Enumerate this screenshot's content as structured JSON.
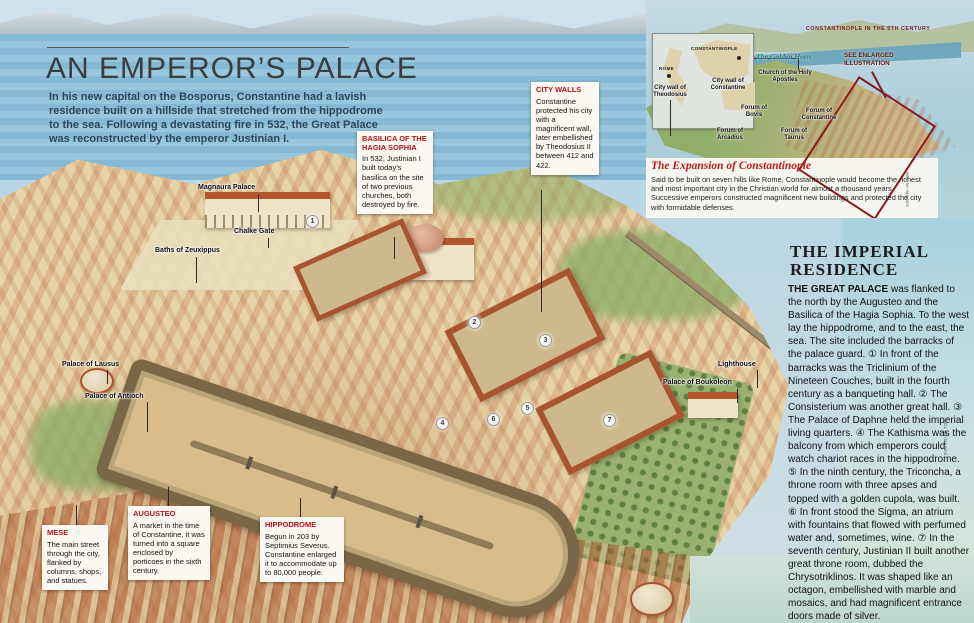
{
  "header": {
    "title": "AN EMPEROR’S PALACE",
    "intro": "In his new capital on the Bosporus, Constantine had a lavish residence built on a hillside that stretched from the hippodrome to the sea. Following a devastating fire in 532, the Great Palace was reconstructed by the emperor Justinian I."
  },
  "callouts": [
    {
      "title": "BASILICA OF THE HAGIA SOPHIA",
      "body": "In 532, Justinian I built today’s basilica on the site of two previous churches, both destroyed by fire."
    },
    {
      "title": "CITY WALLS",
      "body": "Constantine protected his city with a magnificent wall, later embellished by Theodosius II between 412 and 422."
    },
    {
      "title": "MESE",
      "body": "The main street through the city, flanked by columns, shops, and statues."
    },
    {
      "title": "AUGUSTEO",
      "body": "A market in the time of Constantine, it was turned into a square enclosed by porticoes in the sixth century."
    },
    {
      "title": "HIPPODROME",
      "body": "Begun in 203 by Septimius Severus. Constantine enlarged it to accommodate up to 80,000 people."
    }
  ],
  "map_labels": [
    {
      "text": "Magnaura Palace"
    },
    {
      "text": "Chalke Gate"
    },
    {
      "text": "Baths of Zeuxippus"
    },
    {
      "text": "Palace of Lausus"
    },
    {
      "text": "Palace of Antioch"
    },
    {
      "text": "Lighthouse"
    },
    {
      "text": "Palace of Boukoleon"
    }
  ],
  "markers": [
    "1",
    "2",
    "3",
    "4",
    "5",
    "6",
    "7"
  ],
  "inset": {
    "caption": "CONSTANTINOPLE IN THE 5TH CENTURY",
    "locator": {
      "city": "CONSTANTINOPLE",
      "reference": "ROME"
    },
    "labels": {
      "golden_horn": "The Golden Horn",
      "church": "Church of the Holy Apostles",
      "wall_constantine": "City wall of Constantine",
      "wall_theodosius": "City wall of Theodosius",
      "forum_bovis": "Forum of Bovis",
      "forum_constantine": "Forum of Constantine",
      "forum_arcadius": "Forum of Arcadius",
      "forum_taurus": "Forum of Taurus"
    },
    "see_enlarged": "SEE ENLARGED ILLUSTRATION",
    "expansion_title": "The Expansion of Constantinople",
    "expansion_body": "Said to be built on seven hills like Rome, Constantinople would become the richest and most important city in the Christian world for almost a thousand years. Successive emperors constructed magnificent new buildings and protected the city with formidable defenses."
  },
  "sidebar": {
    "title": "THE IMPERIAL RESIDENCE",
    "lead": "THE GREAT PALACE",
    "body": " was flanked to the north by the Augusteo and the Basilica of the Hagia Sophia. To the west lay the hippodrome, and to the east, the sea. The site included the barracks of the palace guard. ① In front of the barracks was the Triclinium of the Nineteen Couches, built in the fourth century as a banqueting hall. ② The Consisterium was another great hall. ③ The Palace of Daphne held the imperial living quarters. ④ The Kathisma was the balcony from which emperors could watch chariot races in the hippodrome. ⑤ In the ninth century, the Triconcha, a throne room with three apses and topped with a golden cupola, was built. ⑥ In front stood the Sigma, an atrium with fountains that flowed with perfumed water and, sometimes, wine. ⑦ In the seventh century, Justinian II built another great throne room, dubbed the Chrysotriklinos. It was shaped like an octagon, embellished with marble and mosaics, and had magnificent entrance doors made of silver."
  },
  "credits": {
    "page": "SOL 90 IMAGES",
    "inset": "SOL 90 IMAGES"
  },
  "colors": {
    "accent_red": "#b5121b",
    "dark_red": "#8b1a1a",
    "teal": "#1f6f6f"
  }
}
